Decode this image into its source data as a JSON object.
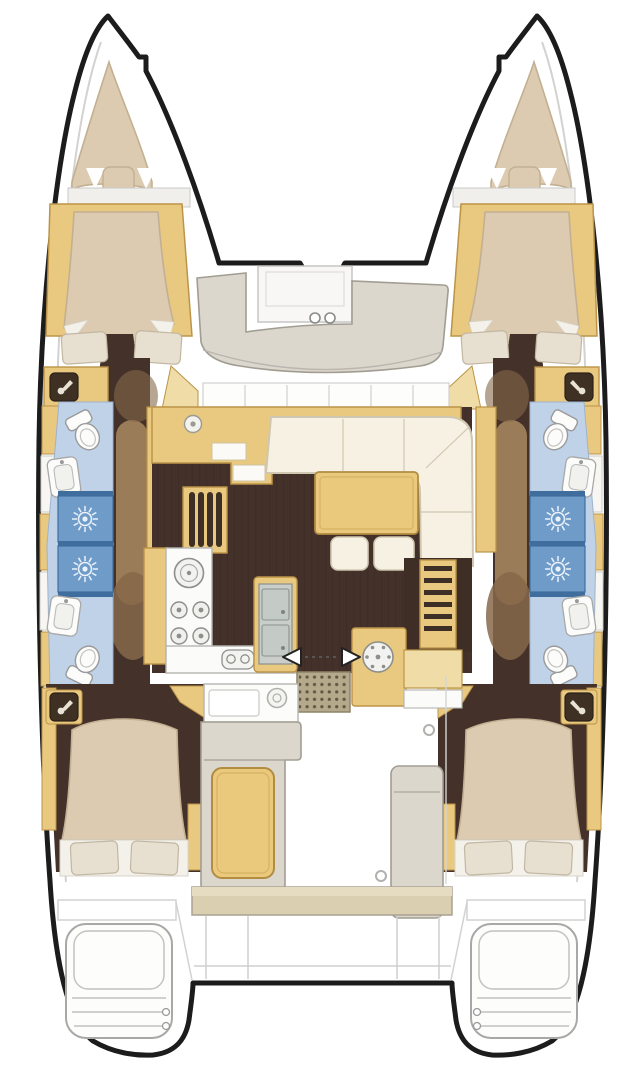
{
  "canvas": {
    "viewBox": "0 0 643 1080",
    "width": "643",
    "height": "1080"
  },
  "diagram": {
    "kind": "catamaran-yacht-floor-plan",
    "orientation": "bow-up",
    "hulls": 2,
    "cabins": 4,
    "bathrooms": 4,
    "showers": 4
  },
  "areas": {
    "port_bow_berth": "port bow peak cushion",
    "starboard_bow_berth": "starboard bow peak cushion",
    "port_forward_cabin": "port forward double cabin",
    "starboard_forward_cabin": "starboard forward double cabin",
    "port_bathroom": "port bathroom with two showers",
    "starboard_bathroom": "starboard bathroom with two showers",
    "foredeck_lounge": "foredeck U-seat with deck rings",
    "salon": "salon with L-sofa, table and two stools",
    "chart_station": "forward sideboard and chart desk",
    "galley": "galley with stove, round sink and double sink island",
    "aft_galley_unit": "aft galley unit with burner",
    "companionway_port": "port companionway steps",
    "companionway_starboard": "starboard companionway steps",
    "entry": "sliding door with arrows and entry mat",
    "cockpit": "cockpit with L-bench, table, wet bar and helm module",
    "port_aft_cabin": "port aft double cabin",
    "starboard_aft_cabin": "starboard aft double cabin",
    "transoms": "twin sugar-scoop transom steps"
  },
  "icons": {
    "shower_head": "radial sun spray symbol",
    "mixer_tap": "lever mixer glyph on dark plate",
    "stove_burners": "2x2 burner rings",
    "round_sink": "ring with center dot",
    "aft_burner": "ring with dot spokes",
    "double_sink": "two steel basins with drains",
    "galley_taps": "twin tap glyph",
    "compass": "ring with dot",
    "sliding_door_arrows": "opposed white arrows",
    "deck_rings": "two small deck circles",
    "portholes": "small deck circles"
  },
  "palette": {
    "white": "#ffffff",
    "outline": "#1c1c1c",
    "lineGray": "#c6c6c4",
    "deckLine": "#d2d2d0",
    "wood": "#e9c87f",
    "woodDark": "#bb9448",
    "woodLight": "#f0dca6",
    "floor": "#44312a",
    "corridor": "#9a7c58",
    "corridorDark": "#86694a",
    "bed": "#dccbb0",
    "bedEdge": "#c3b092",
    "pillow": "#e7dfd0",
    "sheet": "#f3f1ea",
    "cream": "#f6f1e3",
    "creamEdge": "#cfc7b0",
    "bathLight": "#bfd2e8",
    "bathEdge": "#9fb3cd",
    "showerBlue": "#6e9bc8",
    "showerDark": "#3f6e9e",
    "benchGray": "#dcd7cd",
    "benchEdge": "#a29d92",
    "steel": "#c9cecb",
    "steelDark": "#8b9190",
    "mat": "#b4a98b",
    "matDot": "#5f5742",
    "tanBench": "#dbcfb2",
    "tableWood": "#eac87c",
    "tableEdge": "#b28c40",
    "iconDark": "#3e3123",
    "iconGlyph": "#e8e2d5",
    "fixtureEdge": "#9a9a9a",
    "fixtureFill": "#fcfcfb"
  }
}
